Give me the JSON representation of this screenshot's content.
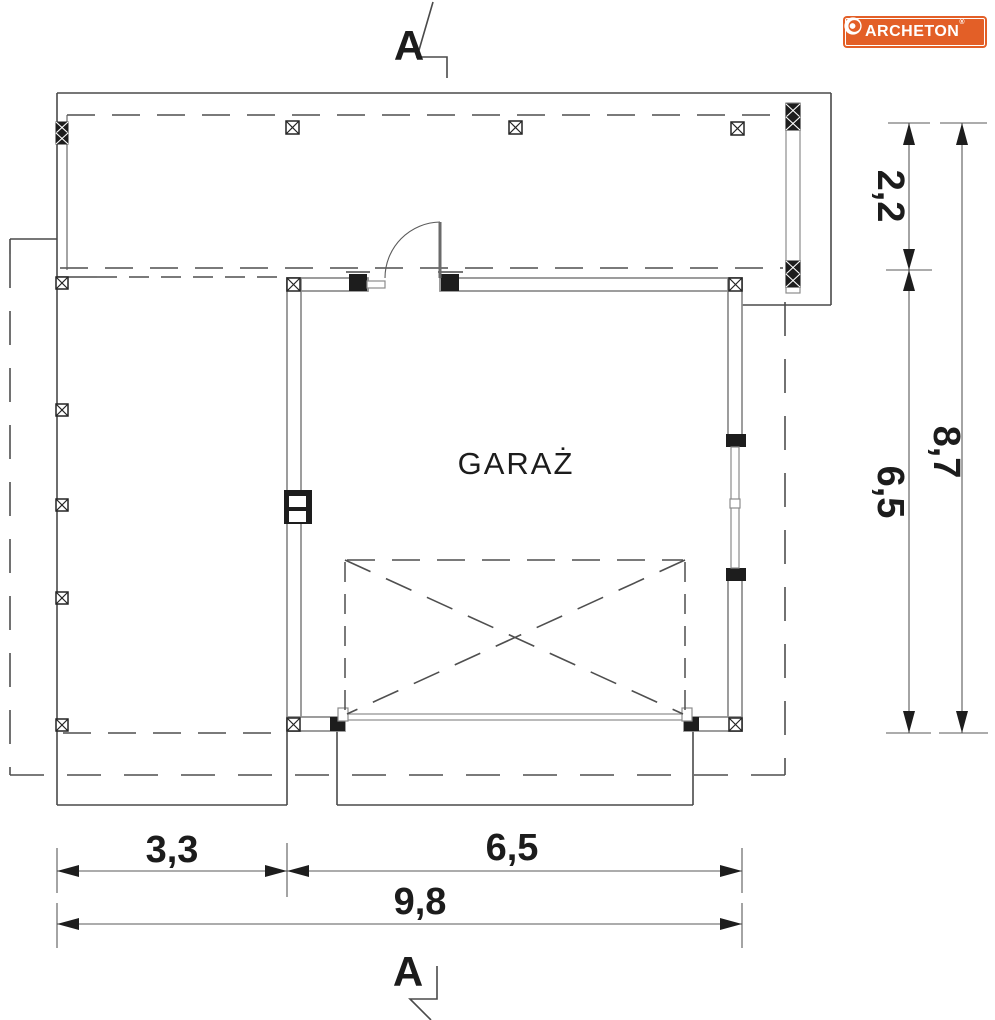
{
  "branding": {
    "logo_text": "ARCHETON",
    "registered_mark": "®",
    "logo_bg_color": "#e35f27",
    "logo_text_color": "#ffffff"
  },
  "section_marks": {
    "top_label": "A",
    "bottom_label": "A"
  },
  "plan": {
    "room_label": "GARAŻ"
  },
  "dimensions": {
    "right": {
      "segment_1": "2,2",
      "segment_2": "6,5",
      "total": "8,7"
    },
    "bottom": {
      "segment_1": "3,3",
      "segment_2": "6,5",
      "total": "9,8"
    }
  },
  "colors": {
    "background": "#ffffff",
    "line": "#4a4a4a",
    "wall_outline": "#8c8c8c",
    "dark_fill": "#1d1d1d",
    "accent": "#e35f27"
  }
}
